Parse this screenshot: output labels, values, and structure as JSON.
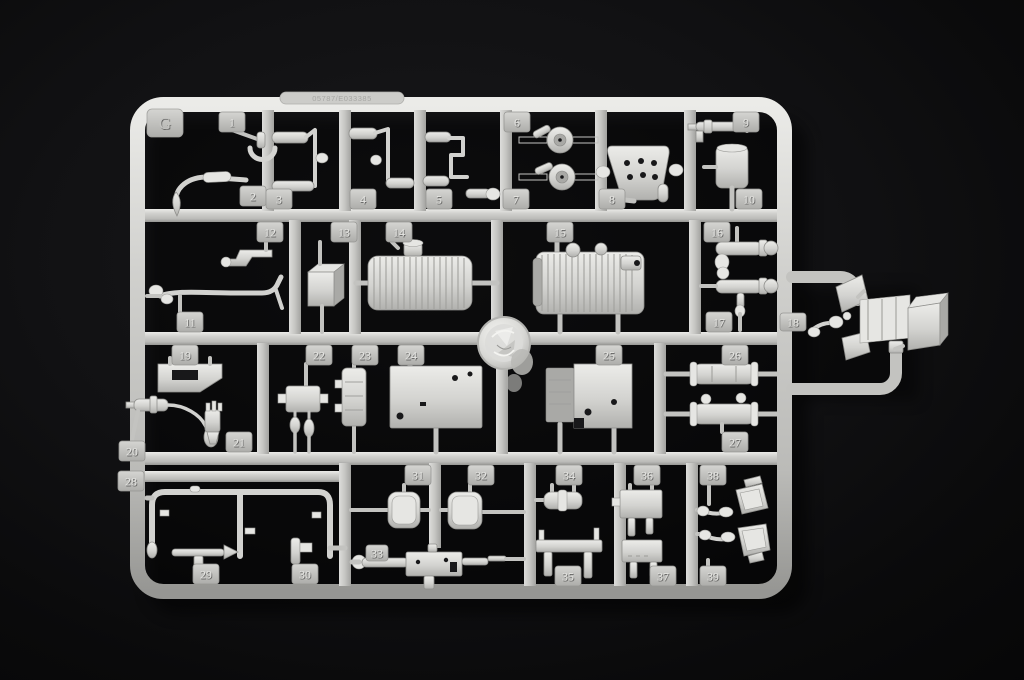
{
  "photo": {
    "description": "Injection-molded light-grey styrene model kit parts sprue (runner G) photographed on a black background",
    "background_color": "#0c0c0e",
    "plastic_color": "#c8c8c5",
    "plastic_highlight": "#ebebe8",
    "plastic_shadow": "#8e8e8b"
  },
  "sprue": {
    "gate_letter": "G",
    "mold_stamp": "05787/E033385",
    "tabs": [
      {
        "label": "1",
        "x": 219,
        "y": 112
      },
      {
        "label": "2",
        "x": 240,
        "y": 186
      },
      {
        "label": "3",
        "x": 266,
        "y": 189
      },
      {
        "label": "4",
        "x": 350,
        "y": 189
      },
      {
        "label": "5",
        "x": 426,
        "y": 189
      },
      {
        "label": "6",
        "x": 504,
        "y": 112
      },
      {
        "label": "7",
        "x": 503,
        "y": 189
      },
      {
        "label": "8",
        "x": 599,
        "y": 189
      },
      {
        "label": "9",
        "x": 733,
        "y": 112
      },
      {
        "label": "10",
        "x": 736,
        "y": 189
      },
      {
        "label": "11",
        "x": 177,
        "y": 312
      },
      {
        "label": "12",
        "x": 257,
        "y": 222
      },
      {
        "label": "13",
        "x": 331,
        "y": 222
      },
      {
        "label": "14",
        "x": 386,
        "y": 222
      },
      {
        "label": "15",
        "x": 547,
        "y": 222
      },
      {
        "label": "16",
        "x": 704,
        "y": 222
      },
      {
        "label": "17",
        "x": 706,
        "y": 312
      },
      {
        "label": "18",
        "x": 780,
        "y": 313,
        "w": 26,
        "h": 18
      },
      {
        "label": "19",
        "x": 172,
        "y": 345
      },
      {
        "label": "20",
        "x": 119,
        "y": 441
      },
      {
        "label": "21",
        "x": 226,
        "y": 432
      },
      {
        "label": "22",
        "x": 306,
        "y": 345
      },
      {
        "label": "23",
        "x": 352,
        "y": 345
      },
      {
        "label": "24",
        "x": 398,
        "y": 345
      },
      {
        "label": "25",
        "x": 596,
        "y": 345
      },
      {
        "label": "26",
        "x": 722,
        "y": 345
      },
      {
        "label": "27",
        "x": 722,
        "y": 432
      },
      {
        "label": "28",
        "x": 118,
        "y": 471
      },
      {
        "label": "29",
        "x": 193,
        "y": 564
      },
      {
        "label": "30",
        "x": 292,
        "y": 564
      },
      {
        "label": "31",
        "x": 405,
        "y": 465
      },
      {
        "label": "32",
        "x": 468,
        "y": 465
      },
      {
        "label": "33",
        "x": 366,
        "y": 545,
        "w": 22,
        "h": 16
      },
      {
        "label": "34",
        "x": 556,
        "y": 465
      },
      {
        "label": "35",
        "x": 555,
        "y": 566
      },
      {
        "label": "36",
        "x": 634,
        "y": 465
      },
      {
        "label": "37",
        "x": 650,
        "y": 566
      },
      {
        "label": "38",
        "x": 700,
        "y": 465
      },
      {
        "label": "39",
        "x": 700,
        "y": 566
      }
    ]
  }
}
